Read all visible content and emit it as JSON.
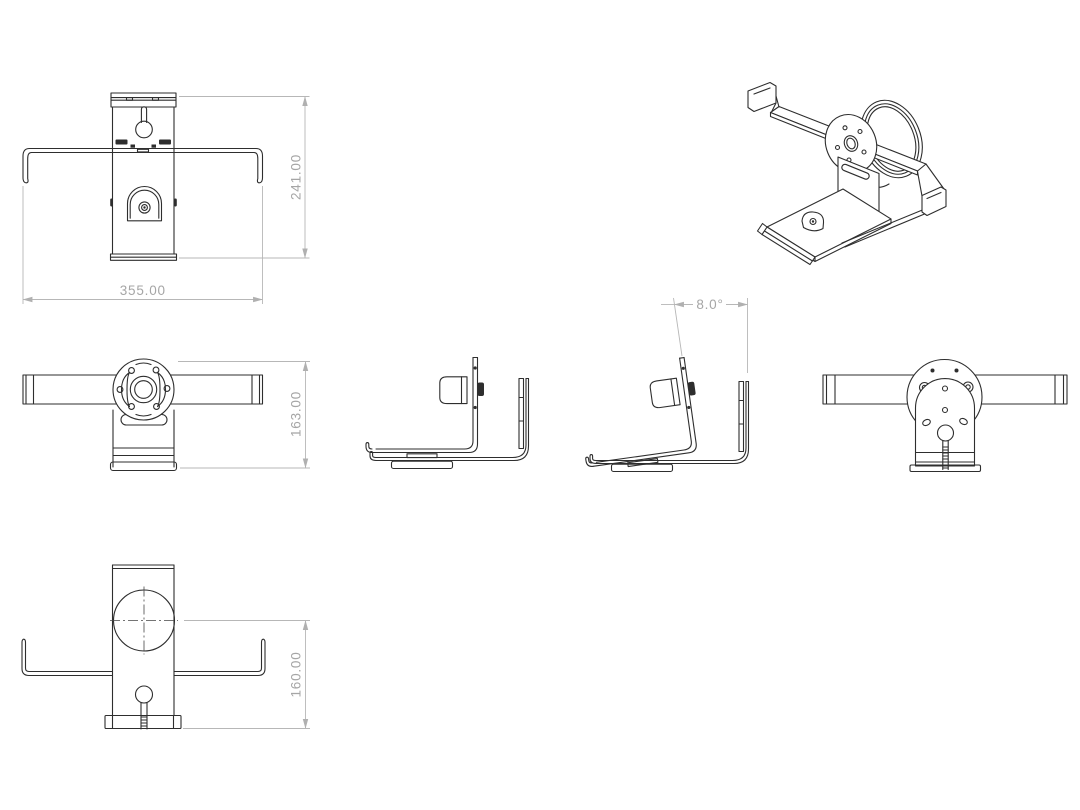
{
  "drawing": {
    "background": "#ffffff",
    "part_line_color": "#2e2e2e",
    "dimension_line_color": "#b7b7b7",
    "dimension_text_color": "#a6a6a6",
    "centerline_color": "#474747"
  },
  "dimensions": {
    "top_view_height": "241.00",
    "top_view_width": "355.00",
    "front_view_height": "163.00",
    "tilt_angle": "8.0°",
    "bottom_view_height": "160.00"
  }
}
